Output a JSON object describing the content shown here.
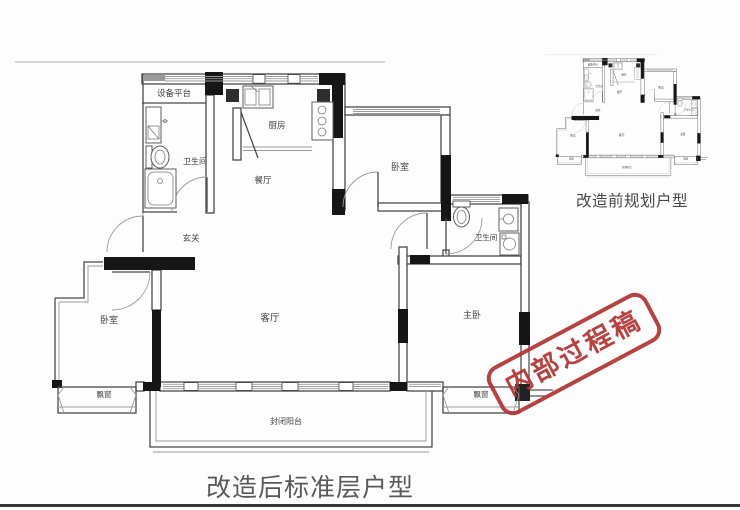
{
  "captions": {
    "main": "改造后标准层户型",
    "before": "改造前规划户型"
  },
  "stamp": {
    "text": "内部过程稿",
    "color": "#b23434"
  },
  "plan": {
    "rooms": {
      "equipment_platform": "设备平台",
      "bathroom_top": "卫生间",
      "kitchen": "厨房",
      "dining": "餐厅",
      "bedroom_top": "卧室",
      "entry": "玄关",
      "living": "客厅",
      "bedroom_left": "卧室",
      "bathroom_right": "卫生间",
      "master_bedroom": "主卧",
      "bay_window_left": "飘窗",
      "bay_window_right": "飘窗",
      "balcony": "封闭阳台"
    }
  },
  "colors": {
    "structural_wall": "#161616",
    "wall_line": "#4a4a4a",
    "stamp_red": "#b23434",
    "bottom_rule": "#39393d"
  }
}
